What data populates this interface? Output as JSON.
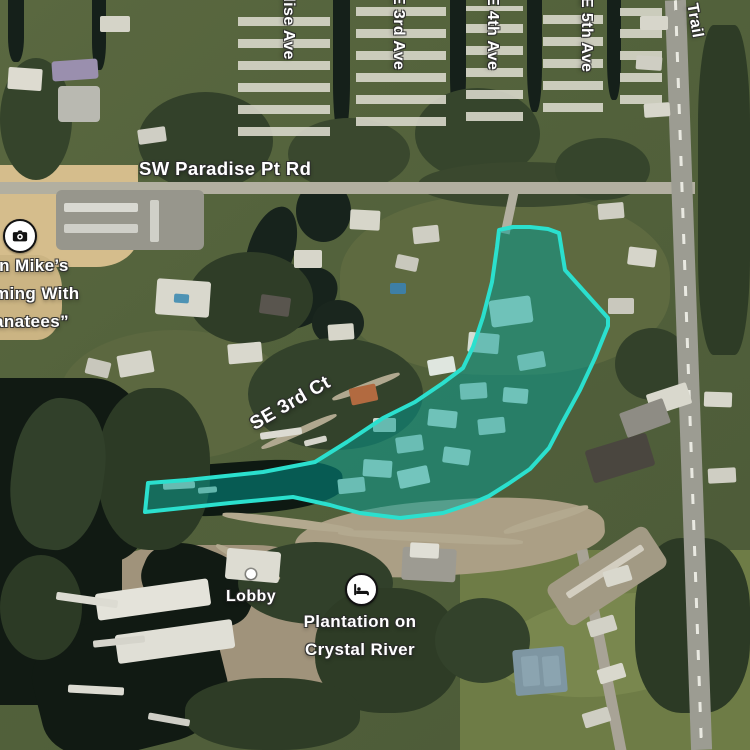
{
  "map": {
    "streets": {
      "paradise_ave": "dise Ave",
      "e_3rd_ave": "E 3rd Ave",
      "e_4th_ave": "E 4th Ave",
      "e_5th_ave": "E 5th Ave",
      "trail": "Trail",
      "sw_paradise_pt_rd": "SW Paradise Pt Rd",
      "se_3rd_ct": "SE 3rd Ct"
    },
    "pois": {
      "attraction": {
        "icon": "camera-icon",
        "lines": [
          "in Mike’s",
          "ming With",
          "anatees”"
        ]
      },
      "lobby": {
        "icon": "dot-marker",
        "label": "Lobby"
      },
      "hotel": {
        "icon": "bed-icon",
        "lines": [
          "Plantation on",
          "Crystal River"
        ]
      }
    },
    "selection": {
      "stroke_color": "#2BE0CE",
      "fill_color": "rgba(0,158,148,0.5)",
      "points": "499,230 513,227 530,227 548,229 559,233 565,270 608,318 608,326 595,358 580,390 562,423 549,448 530,469 508,484 489,496 473,503 443,513 400,518 360,513 337,507 330,505 293,497 230,503 145,512 148,483 187,480 263,472 315,462 347,442 383,418 415,402 443,383 463,368 473,347 483,317 492,282 497,247"
    }
  }
}
